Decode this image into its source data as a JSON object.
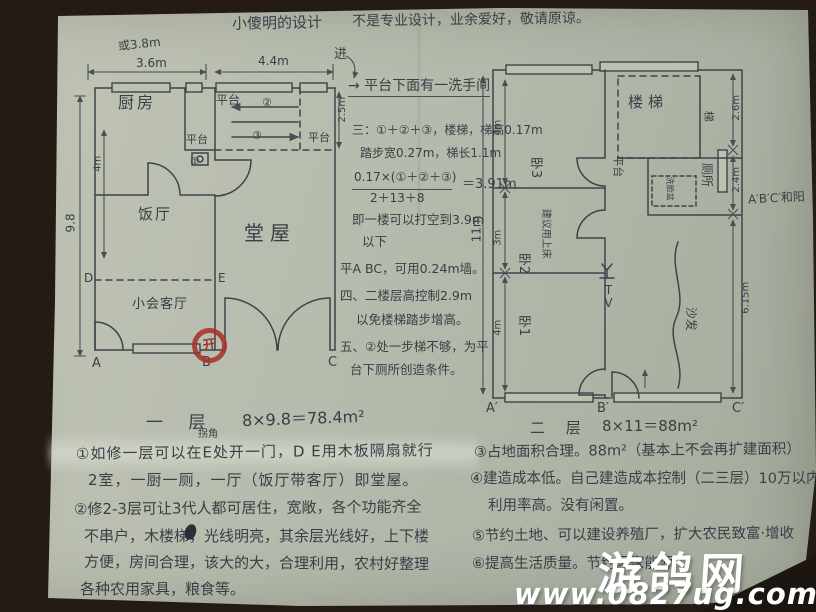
{
  "header": {
    "title": "小傻明的设计",
    "disclaimer": "不是专业设计，业余爱好，敬请原谅。"
  },
  "plan_first_floor": {
    "entry_label": "进",
    "stamp": "开",
    "dims": {
      "alt_width": "或3.8m",
      "w_left": "3.6m",
      "w_right": "4.4m",
      "height": "9.8",
      "kitchen_h": "4m",
      "platform_h": "2.5m"
    },
    "rooms": {
      "kitchen": "厨房",
      "dining": "饭厅",
      "hall": "堂屋",
      "reception": "小会客厅",
      "platform_top": "平台",
      "platform_mid": "平台",
      "platform_right": "平台"
    },
    "stair_marks": {
      "c1": "①",
      "c2": "②",
      "c3": "③"
    },
    "points": {
      "a": "A",
      "b": "B",
      "c": "C",
      "d": "D",
      "e": "E"
    }
  },
  "plan_second_floor": {
    "caption": "二 层",
    "area": "8×11＝88m²",
    "side_note": "A′B′C′和阳",
    "dims": {
      "left_total": "11m",
      "left_1": "4m",
      "left_2": "3m",
      "left_3": "4m",
      "right_1": "2.6m",
      "right_2": "2.4m",
      "right_3": "6.15m"
    },
    "rooms": {
      "stairs": "楼梯",
      "corridor": "梯",
      "platform": "平台",
      "toilet": "厕所",
      "bed3": "卧3",
      "bed2": "卧2",
      "bed1": "卧1"
    },
    "labels": {
      "tv": "TV",
      "sofa": "沙发",
      "basin": "洗脸盆",
      "bed2_note": "建议用上床"
    },
    "points": {
      "a": "A′",
      "b": "B′",
      "c": "C′"
    }
  },
  "middle_notes": {
    "lines": [
      "→ 平台下面有一洗手间",
      "三：①＋②＋③，楼梯，梯高0.17m",
      "踏步宽0.27m，梯长1.1m",
      "0.17×(①＋②＋③)",
      "2＋13＋8",
      "＝3.91m",
      "即一楼可以打空到3.9m",
      "以下",
      "平A BC，可用0.24m墙。",
      "四、二楼层高控制2.9m",
      "以免楼梯踏步增高。",
      "五、②处一步梯不够，为平",
      "台下厕所创造条件。"
    ]
  },
  "notes_left": {
    "caption": "一 层",
    "area": "8×9.8＝78.4m²",
    "insert": "拐角",
    "lines": [
      "①如修一层可以在E处开一门，D E用木板隔扇就行",
      "2室，一厨一厕，一厅（饭厅带客厅）即堂屋。",
      "②修2-3层可让3代人都可居住，宽敞，各个功能齐全",
      "不串户，木楼梯，光线明亮，其余层光线好，上下楼",
      "方便，房间合理，该大的大，合理利用，农村好整理",
      "各种农用家具，粮食等。"
    ]
  },
  "notes_right": {
    "lines": [
      "③占地面积合理。88m²（基本上不会再扩建面积）",
      "④建造成本低。自己建造成本控制（二三层）10万以内",
      "利用率高。没有闲置。",
      "⑤节约土地、可以建设养殖厂，扩大农民致富·增收",
      "⑥提高生活质量。节约国家能源"
    ]
  },
  "watermark": {
    "site": "游鸽网",
    "url": "www.0827ug.com"
  }
}
